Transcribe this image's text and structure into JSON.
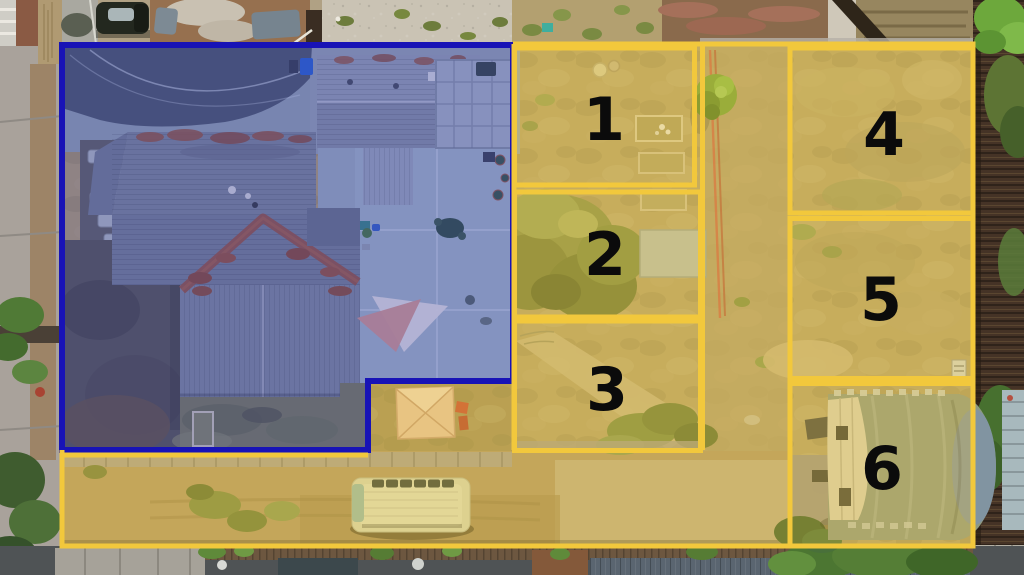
{
  "page": {
    "title": "Aerial drone view of residential property with annotated lot zones",
    "width": 1024,
    "height": 575
  },
  "annotation": {
    "zone_line_color": "#F2C83C",
    "zone_fill_tint": "#ECC43E",
    "house_outline_color": "#1813B6",
    "house_fill_tint": "#2730C8",
    "label_color": "#0B0B0B",
    "zones": [
      {
        "id": "zone-1",
        "label": "1"
      },
      {
        "id": "zone-2",
        "label": "2"
      },
      {
        "id": "zone-3",
        "label": "3"
      },
      {
        "id": "zone-4",
        "label": "4"
      },
      {
        "id": "zone-5",
        "label": "5"
      },
      {
        "id": "zone-6",
        "label": "6"
      }
    ]
  },
  "scene": {
    "features": {
      "house_area": "blue-shaded house, driveway, patio and shade sails",
      "zone_area": "yellow-shaded yard zones, dirt driveway, tent, van, quonset hut"
    },
    "colors": {
      "house_roof": "#7E8890",
      "roof_ridge_rust": "#9C5A38",
      "dry_grass": "#B5A26B",
      "concrete_patio": "#A7B8BD",
      "quonset_hut": "#8E9A82",
      "van_body": "#D6D7B6",
      "tent": "#E6C5A2",
      "corridor_tree": "#74A238",
      "fence_wood": "#453326"
    }
  }
}
